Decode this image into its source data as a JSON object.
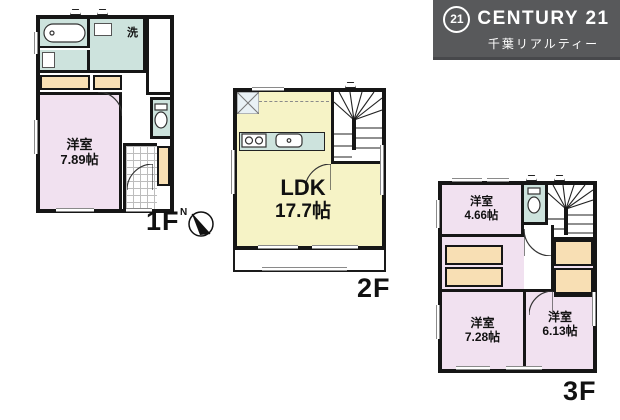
{
  "logo": {
    "circle_text": "21",
    "brand": "CENTURY 21",
    "subtitle": "千葉リアルティー",
    "bg_color": "#58595b",
    "text_color": "#ffffff"
  },
  "compass": {
    "north": "N"
  },
  "floors": {
    "f1": {
      "label": "1F",
      "room": {
        "name": "洋室",
        "size": "7.89帖"
      },
      "laundry": "洗"
    },
    "f2": {
      "label": "2F",
      "room": {
        "name": "LDK",
        "size": "17.7帖"
      }
    },
    "f3": {
      "label": "3F",
      "room_a": {
        "name": "洋室",
        "size": "4.66帖"
      },
      "room_b": {
        "name": "洋室",
        "size": "7.28帖"
      },
      "room_c": {
        "name": "洋室",
        "size": "6.13帖"
      }
    }
  },
  "colors": {
    "room_pink": "#f1e1f0",
    "room_yellow": "#f6f3c6",
    "wet_area_teal": "#cde3dd",
    "closet_tan": "#f8dfb4",
    "wall_black": "#161616"
  }
}
